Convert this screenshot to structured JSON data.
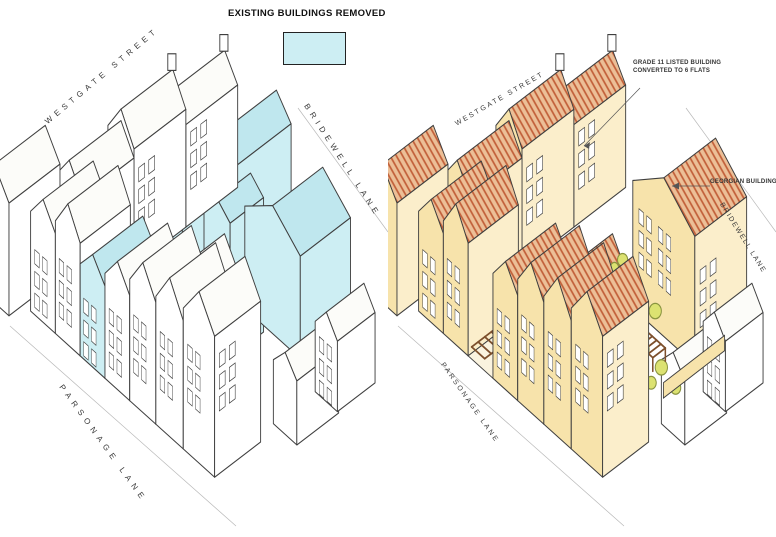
{
  "legend": {
    "title": "EXISTING BUILDINGS REMOVED"
  },
  "left_panel": {
    "description": "existing site axonometric line drawing",
    "streets": {
      "westgate": "WESTGATE STREET",
      "bridewell": "BRIDEWELL LANE",
      "parsonage": "PARSONAGE LANE"
    }
  },
  "right_panel": {
    "description": "proposed scheme colored axonometric",
    "streets": {
      "westgate": "WESTGATE STREET",
      "bridewell": "BRIDEWELL LANE",
      "parsonage": "PARSONAGE LANE"
    },
    "annotations": {
      "grade_listed_line1": "GRADE 11 LISTED BUILDING",
      "grade_listed_line2": "CONVERTED TO 6 FLATS",
      "georgian": "GEORGIAN BUILDING CONVERS"
    }
  },
  "colors": {
    "removed_wall": "#cdeef3",
    "removed_roof": "#bfe7ee",
    "facade_cream": "#f7e3ab",
    "facade_cream_light": "#fbeecb",
    "roof_terracotta_base": "#ecbf97",
    "roof_terracotta_stripe": "#c2603a",
    "roof_gray": "#b7afa7",
    "tree_green": "#dce271",
    "tree_outline": "#8a9440",
    "pergola_brown": "#7c4f2c",
    "line": "#3f3f3f"
  }
}
